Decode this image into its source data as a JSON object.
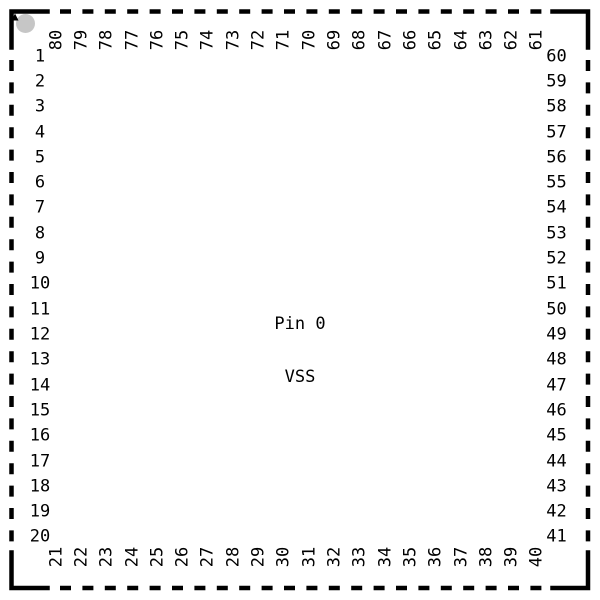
{
  "figure": {
    "type": "ic-package-pinout",
    "pin_count": 80,
    "center_label": {
      "line1": "Pin 0",
      "line2": "VSS"
    },
    "pins": {
      "left": [
        "1",
        "2",
        "3",
        "4",
        "5",
        "6",
        "7",
        "8",
        "9",
        "10",
        "11",
        "12",
        "13",
        "14",
        "15",
        "16",
        "17",
        "18",
        "19",
        "20"
      ],
      "top": [
        "80",
        "79",
        "78",
        "77",
        "76",
        "75",
        "74",
        "73",
        "72",
        "71",
        "70",
        "69",
        "68",
        "67",
        "66",
        "65",
        "64",
        "63",
        "62",
        "61"
      ],
      "right": [
        "60",
        "59",
        "58",
        "57",
        "56",
        "55",
        "54",
        "53",
        "52",
        "51",
        "50",
        "49",
        "48",
        "47",
        "46",
        "45",
        "44",
        "43",
        "42",
        "41"
      ],
      "bottom": [
        "21",
        "22",
        "23",
        "24",
        "25",
        "26",
        "27",
        "28",
        "29",
        "30",
        "31",
        "32",
        "33",
        "34",
        "35",
        "36",
        "37",
        "38",
        "39",
        "40"
      ]
    },
    "colors": {
      "background": "#ffffff",
      "outline": "#000000",
      "text": "#000000",
      "pin1_marker_dot": "#c6c6c6",
      "pin1_marker_arrow": "#000000"
    }
  }
}
